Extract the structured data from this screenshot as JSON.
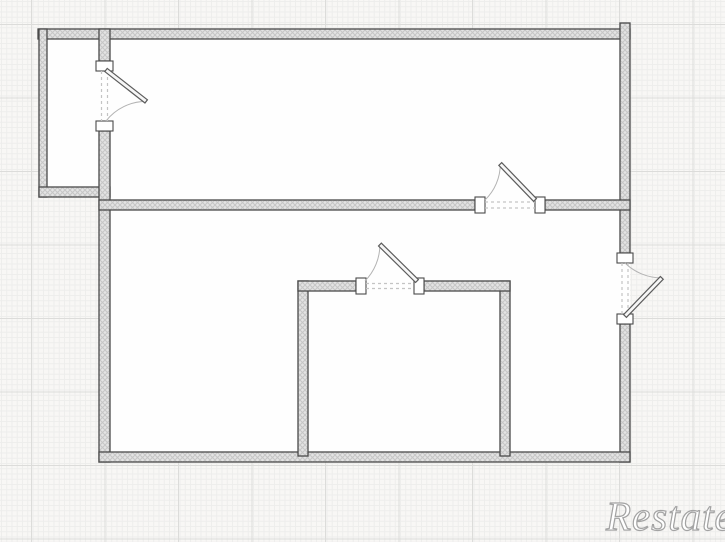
{
  "watermark": {
    "text": "Restate"
  },
  "colors": {
    "background": "#f8f7f5",
    "grid_minor": "#ededec",
    "grid_major": "#dcdcda",
    "wall_fill": "#e4e4e4",
    "wall_hatch": "#c6c6c6",
    "wall_border": "#4a4a4a",
    "room_fill": "#fefefe",
    "jamb_fill": "#ffffff",
    "door_leaf_fill": "#f6f6f6",
    "door_leaf_border": "#5c5c5c",
    "swing_arc": "#b3b3b3",
    "opening_dash": "#c4c4c4",
    "watermark_fill": "#ffffff",
    "watermark_stroke": "#a3a3a3"
  },
  "plan": {
    "type": "apartment-floor-plan",
    "rooms_visible": 4,
    "doors_visible": 4,
    "doors": [
      "door between top-left closet and upper room, hinged top, opens right into upper room",
      "door in middle dividing wall near right side, hinged right, opens up into upper room",
      "door in right exterior wall below dividing wall, hinged bottom, opens outward to the right",
      "door in inner room top wall, hinged right, opens up-left out of inner room"
    ]
  }
}
